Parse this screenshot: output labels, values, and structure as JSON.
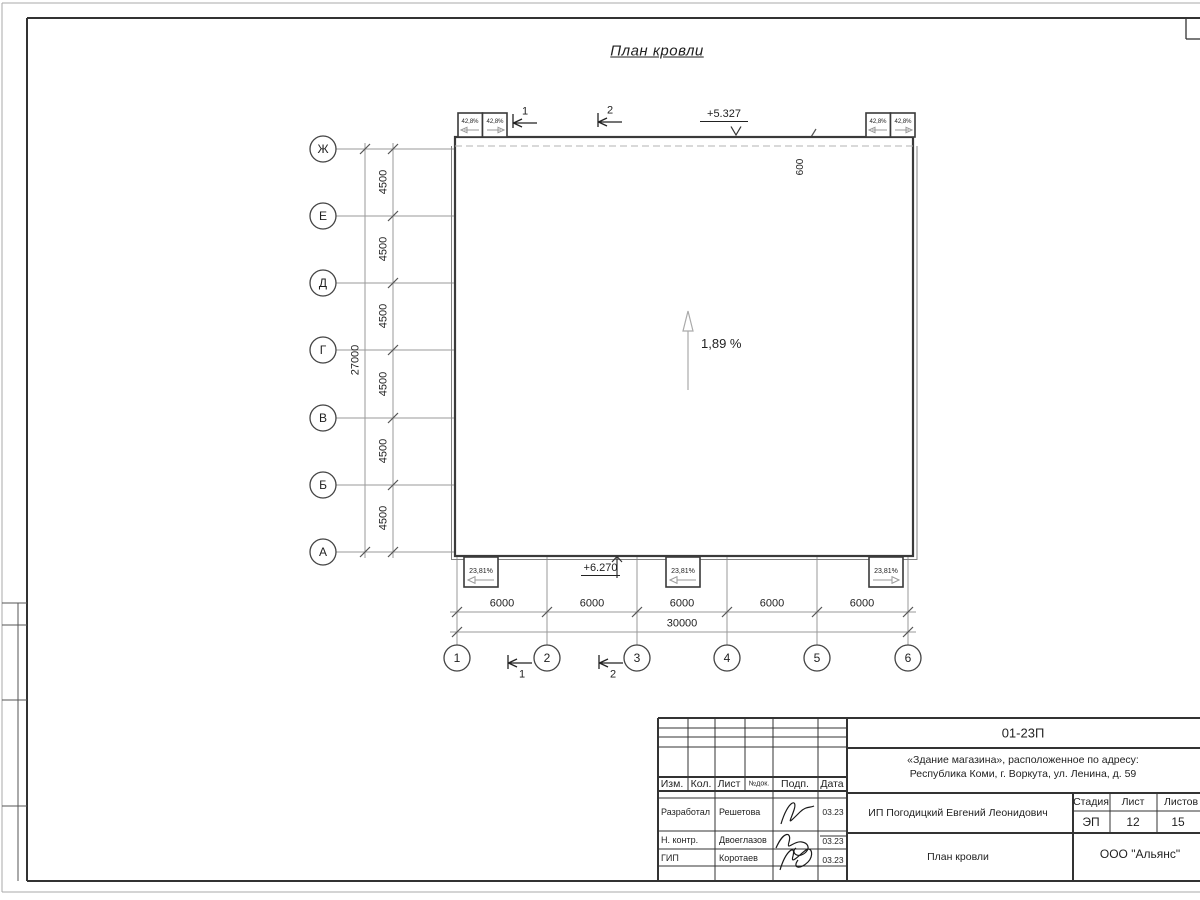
{
  "drawing": {
    "title": "План кровли",
    "grid": {
      "row_labels": [
        "Ж",
        "Е",
        "Д",
        "Г",
        "В",
        "Б",
        "А"
      ],
      "col_labels": [
        "1",
        "2",
        "3",
        "4",
        "5",
        "6"
      ],
      "row_dim": "4500",
      "row_total": "27000",
      "col_dim": "6000",
      "col_total": "30000"
    },
    "marks": {
      "elev_roof": "+5.327",
      "elev_canopy": "+6.270",
      "overhang": "600",
      "slope_main": "1,89 %",
      "slope_small_top": "42,8%",
      "slope_small_bottom": "23,81%",
      "section_1": "1",
      "section_2": "2"
    }
  },
  "titleblock": {
    "doc_number": "01-23П",
    "object_line1": "«Здание магазина», расположенное по адресу:",
    "object_line2": "Республика Коми, г. Воркута, ул. Ленина, д. 59",
    "header": {
      "izm": "Изм.",
      "kol": "Кол.",
      "list": "Лист",
      "ndok": "№док.",
      "podp": "Подп.",
      "data": "Дата"
    },
    "rows": [
      {
        "role": "Разработал",
        "name": "Решетова",
        "date": "03.23"
      },
      {
        "role": "Н. контр.",
        "name": "Двоеглазов",
        "date": "03.23"
      },
      {
        "role": "ГИП",
        "name": "Коротаев",
        "date": "03.23"
      }
    ],
    "client": "ИП Погодицкий Евгений Леонидович",
    "stage_label": "Стадия",
    "sheet_label": "Лист",
    "sheets_label": "Листов",
    "stage": "ЭП",
    "sheet": "12",
    "sheets": "15",
    "sheet_title": "План кровли",
    "company": "ООО \"Альянс\""
  }
}
